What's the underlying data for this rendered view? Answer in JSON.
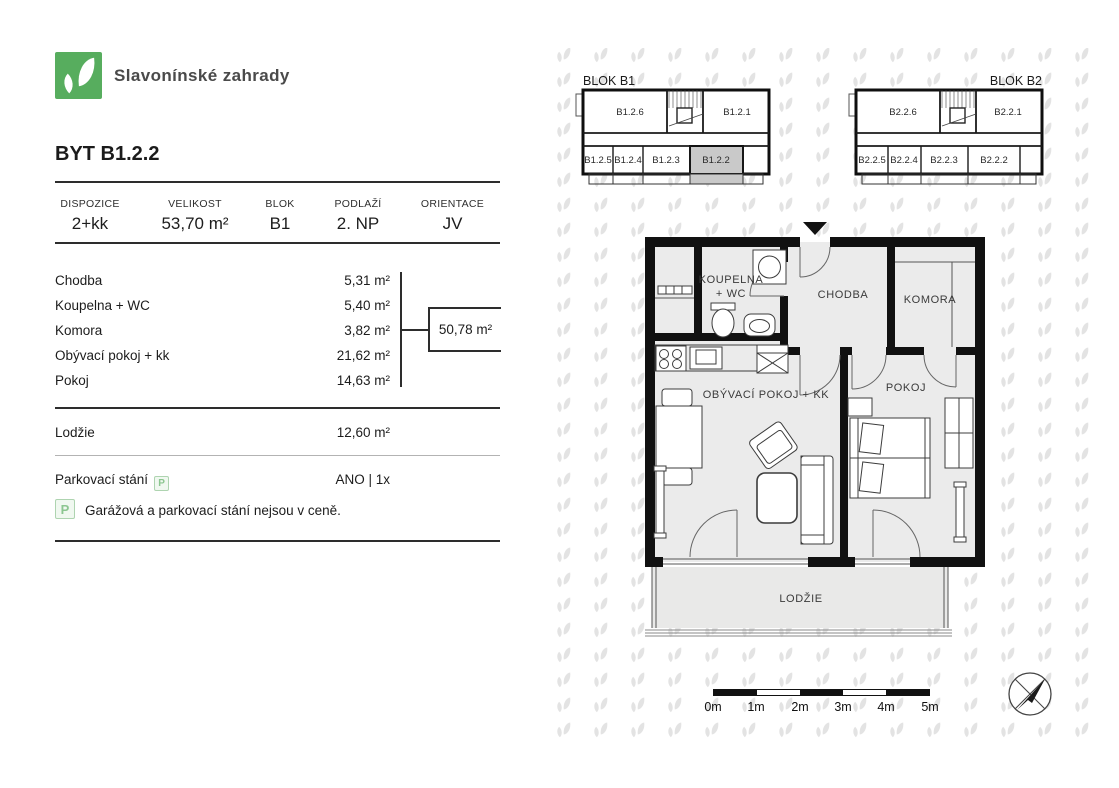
{
  "brand": {
    "name": "Slavonínské zahrady"
  },
  "page": {
    "title": "BYT B1.2.2"
  },
  "summary": {
    "columns": [
      {
        "label": "DISPOZICE",
        "value": "2+kk"
      },
      {
        "label": "VELIKOST",
        "value": "53,70 m²"
      },
      {
        "label": "BLOK",
        "value": "B1"
      },
      {
        "label": "PODLAŽÍ",
        "value": "2. NP"
      },
      {
        "label": "ORIENTACE",
        "value": "JV"
      }
    ]
  },
  "rooms": [
    {
      "label": "Chodba",
      "area": "5,31 m²"
    },
    {
      "label": "Koupelna + WC",
      "area": "5,40 m²"
    },
    {
      "label": "Komora",
      "area": "3,82 m²"
    },
    {
      "label": "Obývací pokoj + kk",
      "area": "21,62 m²"
    },
    {
      "label": "Pokoj",
      "area": "14,63 m²"
    }
  ],
  "interior_total": "50,78 m²",
  "lodzie_row": {
    "label": "Lodžie",
    "area": "12,60 m²"
  },
  "parking": {
    "label": "Parkovací stání",
    "icon": "P",
    "value": "ANO | 1x",
    "note": "Garážová a parkovací stání nejsou v ceně."
  },
  "blocks": {
    "b1": {
      "title": "BLOK B1",
      "units": [
        "B1.2.6",
        "B1.2.1",
        "B1.2.5",
        "B1.2.4",
        "B1.2.3",
        "B1.2.2"
      ],
      "highlighted_unit": "B1.2.2"
    },
    "b2": {
      "title": "BLOK B2",
      "units": [
        "B2.2.6",
        "B2.2.1",
        "B2.2.5",
        "B2.2.4",
        "B2.2.3",
        "B2.2.2"
      ]
    }
  },
  "plan": {
    "labels": {
      "koupelna_line1": "KOUPELNA",
      "koupelna_line2": "+ WC",
      "chodba": "CHODBA",
      "komora": "KOMORA",
      "obyvaci": "OBÝVACÍ POKOJ + KK",
      "pokoj": "POKOJ",
      "lodzie": "LODŽIE"
    }
  },
  "scale_bar": {
    "labels": [
      "0m",
      "1m",
      "2m",
      "3m",
      "4m",
      "5m"
    ]
  },
  "colors": {
    "brand_green": "#57ad5e",
    "highlight_gray": "#c9c9c9",
    "pattern_gray": "#e3e3e3",
    "wall_black": "#111111"
  }
}
